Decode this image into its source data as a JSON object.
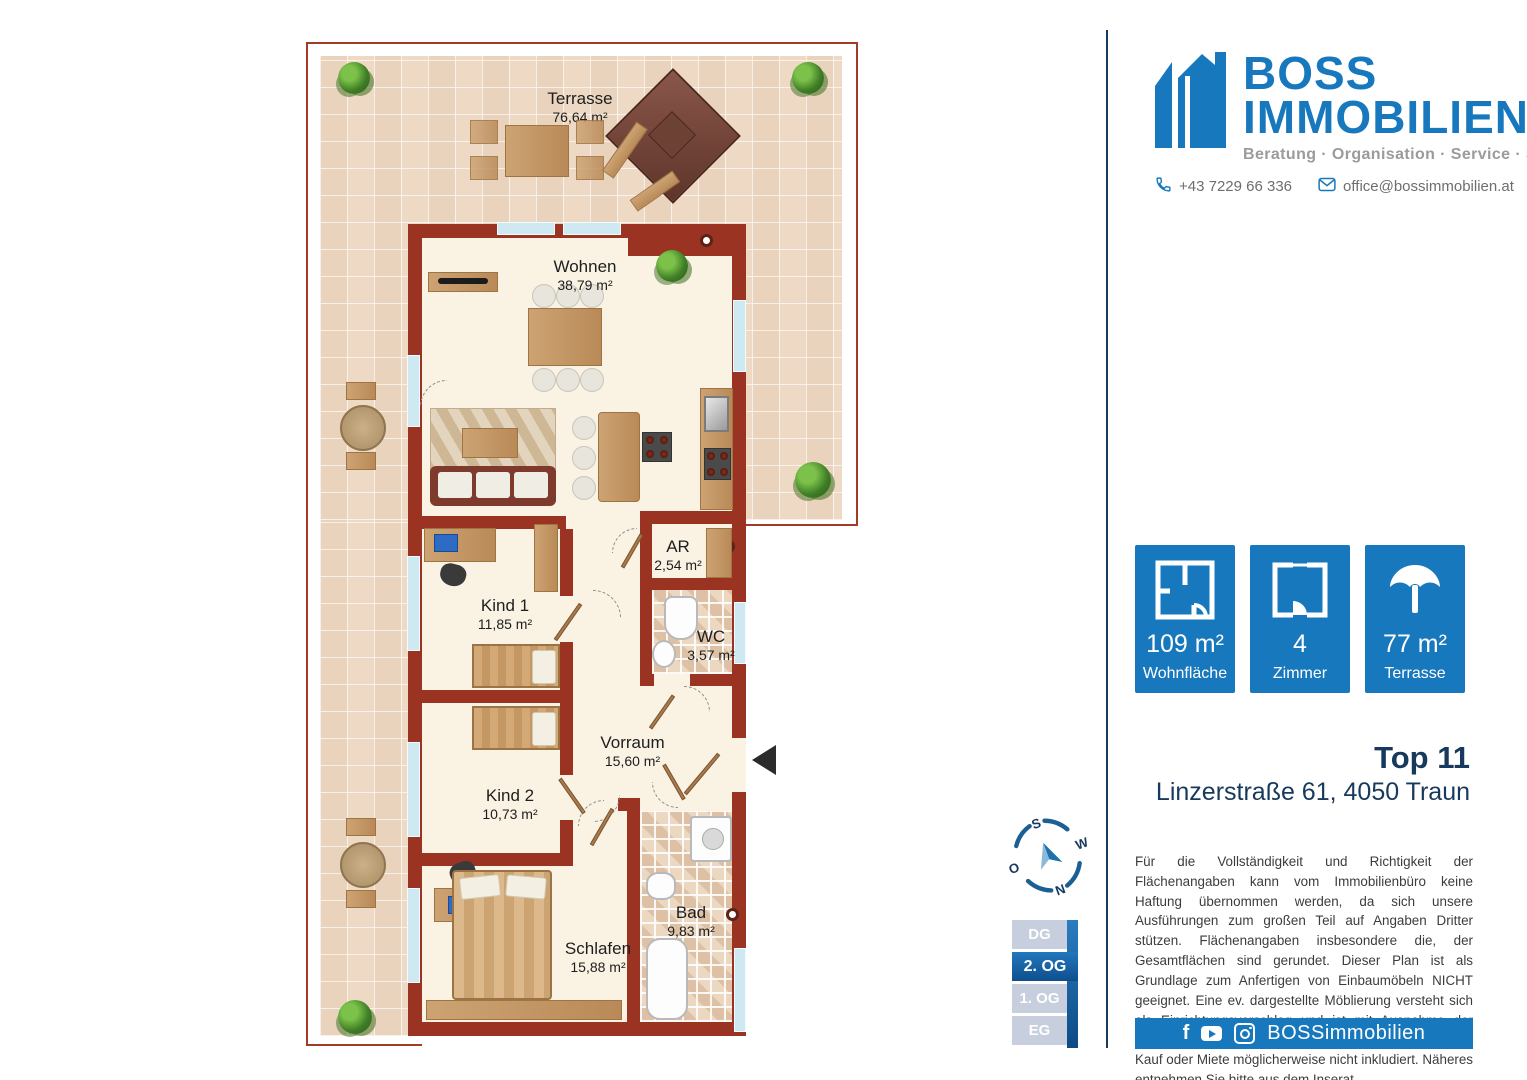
{
  "brand": {
    "line1": "BOSS",
    "line2": "IMMOBILIEN",
    "tagline": "Beratung · Organisation · Service · Sicherheit",
    "phone": "+43 7229 66 336",
    "email": "office@bossimmobilien.at",
    "blue": "#1878be",
    "navy": "#16395c"
  },
  "listing": {
    "title": "Top 11",
    "address": "Linzerstraße 61, 4050 Traun"
  },
  "stats": [
    {
      "icon": "floorplan-icon",
      "value": "109 m²",
      "label": "Wohnfläche"
    },
    {
      "icon": "room-door-icon",
      "value": "4",
      "label": "Zimmer"
    },
    {
      "icon": "parasol-icon",
      "value": "77 m²",
      "label": "Terrasse"
    }
  ],
  "floors": {
    "items": [
      "DG",
      "2. OG",
      "1. OG",
      "EG"
    ],
    "active": "2. OG"
  },
  "compass": {
    "n": "N",
    "e": "O",
    "s": "S",
    "w": "W"
  },
  "rooms": [
    {
      "name": "Terrasse",
      "area": "76,64 m²"
    },
    {
      "name": "Wohnen",
      "area": "38,79 m²"
    },
    {
      "name": "AR",
      "area": "2,54 m²"
    },
    {
      "name": "WC",
      "area": "3,57 m²"
    },
    {
      "name": "Kind 1",
      "area": "11,85 m²"
    },
    {
      "name": "Vorraum",
      "area": "15,60 m²"
    },
    {
      "name": "Kind 2",
      "area": "10,73 m²"
    },
    {
      "name": "Schlafen",
      "area": "15,88 m²"
    },
    {
      "name": "Bad",
      "area": "9,83 m²"
    }
  ],
  "disclaimer": "Für die Vollständigkeit und Richtigkeit der Flächenangaben kann vom Immobilienbüro keine Haftung übernommen werden, da sich unsere Ausführungen zum großen Teil auf Angaben Dritter stützen. Flächenangaben insbesondere die, der Gesamtflächen sind gerundet. Dieser Plan ist als Grundlage zum Anfertigen von Einbaumöbeln NICHT geeignet. Eine ev. dargestellte Möblierung versteht sich als Einrichtungsvorschlag und ist mit Ausnahme der Sanitärkeramik, Badewanne und/oder Duschanlage, bei Kauf oder Miete möglicherweise nicht inkludiert. Näheres entnehmen Sie bitte aus dem Inserat.",
  "footer": {
    "handle": "BOSSimmobilien"
  },
  "colors": {
    "wall_red": "#9a3322",
    "tile_beige": "#edd9c4",
    "floor_cream": "#faf3e4"
  }
}
